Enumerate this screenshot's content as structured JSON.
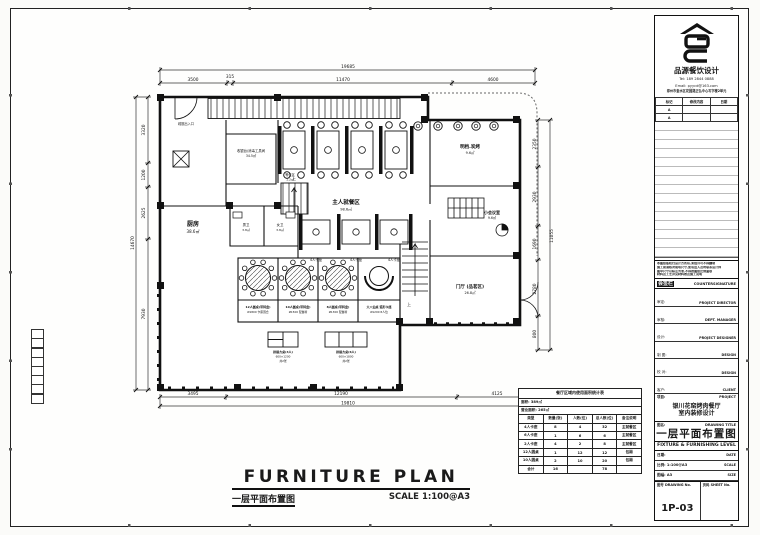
{
  "footer": {
    "title": "FURNITURE PLAN",
    "cn": "一层平面布置图",
    "scale": "SCALE  1:100@A3"
  },
  "titleblock": {
    "company": "品源餐饮设计",
    "tel": "Tel: 189 2844 0888",
    "email": "Email: pyycd@163.com",
    "address": "郑州市金水区花园路正弘中心写字楼2单元",
    "rev_headers": [
      "标记",
      "修改内容",
      "日期"
    ],
    "rev_rows": [
      [
        "A",
        "",
        ""
      ],
      [
        "A",
        "",
        ""
      ]
    ],
    "notes": [
      "本图纸版权归设计方所有,未经许可不得翻制",
      "施工前请核对现场尺寸,如有出入及时联系设计师",
      "图中尺寸以标注为准,不得按图纸比例量取",
      "材料及工艺详见材料表及施工说明"
    ],
    "countersign_cn": "会签栏",
    "countersign_en": "COUNTERSIGNATURE",
    "sign_rows": [
      {
        "cn": "审定:",
        "en": "PROJECT DIRECTOR"
      },
      {
        "cn": "审核:",
        "en": "DEPT. MANAGER"
      },
      {
        "cn": "设计:",
        "en": "PROJECT DESIGNER"
      },
      {
        "cn": "制 图:",
        "en": "DESIGN"
      },
      {
        "cn": "校 对:",
        "en": "DESIGN"
      },
      {
        "cn": "客户:",
        "en": "CLIENT"
      }
    ],
    "project_label_cn": "项目:",
    "project_label_en": "PROJECT",
    "project_name_1": "银川花窑烤肉餐厅",
    "project_name_2": "室内装修设计",
    "dt_label_cn": "图名:",
    "dt_label_en": "DRAWING TITLE",
    "dt_cn": "一层平面布置图",
    "dt_en": "FIXTURE & FURNISHING LEVEL",
    "meta_rows": [
      {
        "cn": "日期:",
        "en": "DATE"
      },
      {
        "cn": "比例: 1:100@A3",
        "en": "SCALE"
      },
      {
        "cn": "图幅: A3",
        "en": "SIZE"
      }
    ],
    "dno_label_cn": "图号",
    "dno_label_en": "DRAWING No.",
    "sheet_label_cn": "页码",
    "sheet_label_en": "SHEET No.",
    "drawing_no": "1P-03"
  },
  "stats": {
    "title": "餐厅区域内使用面积统计表",
    "sub1": "面积: 389㎡",
    "sub2": "营业面积: 265㎡",
    "headers": [
      "类型",
      "数量(张)",
      "人数(位)",
      "总人数(位)",
      "备注说明"
    ],
    "rows": [
      [
        "4人卡座",
        "8",
        "4",
        "32",
        "主就餐区"
      ],
      [
        "6人卡座",
        "1",
        "6",
        "6",
        "主就餐区"
      ],
      [
        "2人卡座",
        "4",
        "2",
        "8",
        "主就餐区"
      ],
      [
        "12人圆桌",
        "1",
        "12",
        "12",
        "包厢"
      ],
      [
        "10人圆桌",
        "2",
        "10",
        "20",
        "包厢"
      ],
      [
        "合计",
        "16",
        "",
        "78",
        ""
      ]
    ]
  },
  "dims": {
    "top_overall": "19685",
    "top_segs": [
      "3500",
      "315",
      "11470",
      "4600"
    ],
    "bottom_segs": [
      "3495",
      "12190",
      "4125"
    ],
    "bottom_overall": "19810",
    "left_overall": "14670",
    "left_segs": [
      "3320",
      "1200",
      "2625",
      "7930"
    ],
    "right_overall": "11055",
    "right_segs": [
      "2350",
      "2930",
      "1690",
      "2780",
      "800"
    ]
  },
  "rooms": {
    "kitchen": {
      "name": "厨房",
      "area": "38.6㎡"
    },
    "cashier": {
      "name": "收银台/消毒工具间",
      "area": "34.5㎡"
    },
    "dining": {
      "name": "主人就餐区",
      "area": "98.6㎡"
    },
    "bbq": {
      "name": "明档.炭烤",
      "area": "9.6㎡"
    },
    "meeting": {
      "name": "小会议室",
      "area": "9.6㎡"
    },
    "foyer": {
      "name": "门厅 (品茗区)",
      "area": "26.8㎡"
    },
    "wc_m": {
      "name": "男卫",
      "area": "3.8㎡"
    },
    "wc_f": {
      "name": "女卫",
      "area": "3.8㎡"
    },
    "waiting": {
      "name": "等位区",
      "area": "1.2㎡"
    },
    "exit": {
      "name": "疏散出入口"
    },
    "up": "上"
  },
  "booths": {
    "row2_label": "4人卡座"
  },
  "tables": {
    "t1": [
      "12人圆桌(带转盘)",
      "Ø1800 卡座围合"
    ],
    "t2": [
      "10人圆桌(带转盘)",
      "Ø1500 配餐椅"
    ],
    "t3": [
      "8人圆桌(带转盘)",
      "Ø1300 配餐椅"
    ],
    "t4": [
      "大八仙桌 弧形卡座",
      "Ø1200 8人位"
    ],
    "s1": [
      "拼接方桌(4人)",
      "600×1200",
      "共2张"
    ],
    "s2": [
      "拼接方桌(6人)",
      "600×1800",
      "共2张"
    ]
  }
}
